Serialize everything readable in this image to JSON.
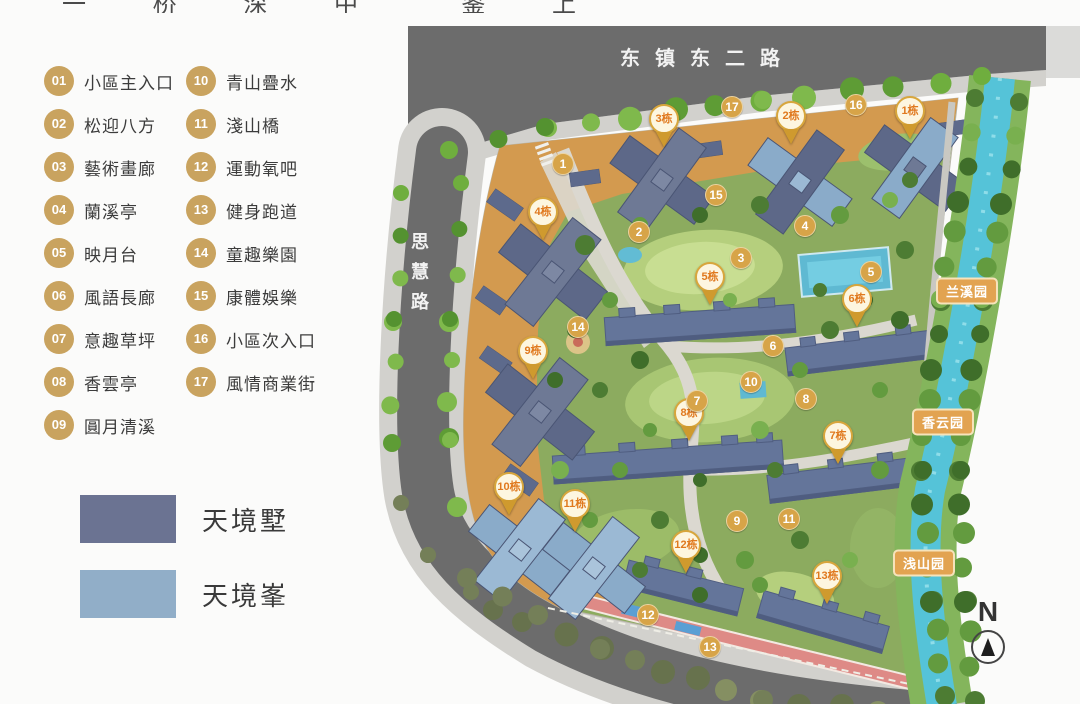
{
  "top_caption": "一 桥 深 中  鉴 上 一 层",
  "legend": {
    "items": [
      {
        "num": "01",
        "label": "小區主入口"
      },
      {
        "num": "02",
        "label": "松迎八方"
      },
      {
        "num": "03",
        "label": "藝術畫廊"
      },
      {
        "num": "04",
        "label": "蘭溪亭"
      },
      {
        "num": "05",
        "label": "映月台"
      },
      {
        "num": "06",
        "label": "風語長廊"
      },
      {
        "num": "07",
        "label": "意趣草坪"
      },
      {
        "num": "08",
        "label": "香雲亭"
      },
      {
        "num": "09",
        "label": "圓月清溪"
      },
      {
        "num": "10",
        "label": "青山疊水"
      },
      {
        "num": "11",
        "label": "淺山橋"
      },
      {
        "num": "12",
        "label": "運動氧吧"
      },
      {
        "num": "13",
        "label": "健身跑道"
      },
      {
        "num": "14",
        "label": "童趣樂園"
      },
      {
        "num": "15",
        "label": "康體娛樂"
      },
      {
        "num": "16",
        "label": "小區次入口"
      },
      {
        "num": "17",
        "label": "風情商業街"
      }
    ],
    "swatches": [
      {
        "label": "天境墅",
        "color": "#6b7392"
      },
      {
        "label": "天境峯",
        "color": "#91aec8"
      }
    ]
  },
  "map": {
    "roads": {
      "top": "东镇东二路",
      "left": "思慧路"
    },
    "parks": [
      {
        "label": "兰溪园",
        "x": 967,
        "y": 291
      },
      {
        "label": "香云园",
        "x": 943,
        "y": 422
      },
      {
        "label": "浅山园",
        "x": 924,
        "y": 563
      }
    ],
    "buildings": [
      {
        "label": "1栋",
        "x": 910,
        "y": 127
      },
      {
        "label": "2栋",
        "x": 791,
        "y": 132
      },
      {
        "label": "3栋",
        "x": 664,
        "y": 135
      },
      {
        "label": "4栋",
        "x": 543,
        "y": 228
      },
      {
        "label": "5栋",
        "x": 710,
        "y": 293
      },
      {
        "label": "6栋",
        "x": 857,
        "y": 315
      },
      {
        "label": "7栋",
        "x": 838,
        "y": 452
      },
      {
        "label": "8栋",
        "x": 689,
        "y": 429
      },
      {
        "label": "9栋",
        "x": 533,
        "y": 367
      },
      {
        "label": "10栋",
        "x": 509,
        "y": 503
      },
      {
        "label": "11栋",
        "x": 575,
        "y": 520
      },
      {
        "label": "12栋",
        "x": 686,
        "y": 561
      },
      {
        "label": "13栋",
        "x": 827,
        "y": 592
      }
    ],
    "amenities": [
      {
        "num": "1",
        "x": 563,
        "y": 164
      },
      {
        "num": "2",
        "x": 639,
        "y": 232
      },
      {
        "num": "3",
        "x": 741,
        "y": 258
      },
      {
        "num": "4",
        "x": 805,
        "y": 226
      },
      {
        "num": "5",
        "x": 871,
        "y": 272
      },
      {
        "num": "6",
        "x": 773,
        "y": 346
      },
      {
        "num": "7",
        "x": 697,
        "y": 401
      },
      {
        "num": "8",
        "x": 806,
        "y": 399
      },
      {
        "num": "9",
        "x": 737,
        "y": 521
      },
      {
        "num": "10",
        "x": 751,
        "y": 382
      },
      {
        "num": "11",
        "x": 789,
        "y": 519
      },
      {
        "num": "12",
        "x": 648,
        "y": 615
      },
      {
        "num": "13",
        "x": 710,
        "y": 647
      },
      {
        "num": "14",
        "x": 578,
        "y": 327
      },
      {
        "num": "15",
        "x": 716,
        "y": 195
      },
      {
        "num": "16",
        "x": 856,
        "y": 105
      },
      {
        "num": "17",
        "x": 732,
        "y": 107
      }
    ],
    "compass": {
      "label": "N"
    }
  },
  "colors": {
    "accent_gold": "#c9a35f",
    "marker_gold": "#d7a448",
    "badge_orange": "#e2a351",
    "villa_dark": "#6b7392",
    "peak_light": "#91aec8",
    "river": "#55c3d8",
    "commercial_orange": "#d39a4f",
    "asphalt": "#6c6c6c",
    "track_pink": "#de8a86"
  }
}
